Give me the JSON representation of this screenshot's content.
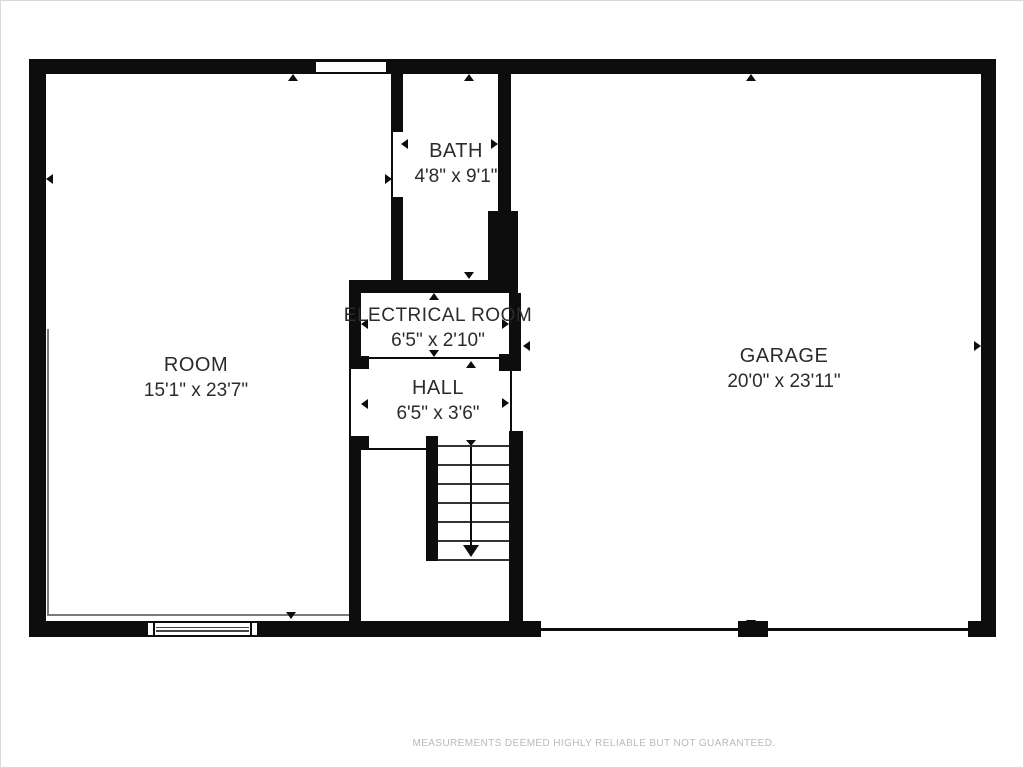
{
  "plan": {
    "rooms": [
      {
        "name": "ROOM",
        "dims": "15'1\" x 23'7\""
      },
      {
        "name": "BATH",
        "dims": "4'8\" x 9'1\""
      },
      {
        "name": "ELECTRICAL ROOM",
        "dims": "6'5\" x 2'10\""
      },
      {
        "name": "HALL",
        "dims": "6'5\" x 3'6\""
      },
      {
        "name": "GARAGE",
        "dims": "20'0\" x 23'11\""
      }
    ],
    "stairs": {
      "direction_icon": "down-arrow"
    },
    "footer_disclaimer": "MEASUREMENTS DEEMED HIGHLY RELIABLE BUT NOT GUARANTEED.",
    "colors": {
      "wall": "#0d0d0d",
      "label_text": "#2b2b2b",
      "footer_text": "#b9b9b9"
    }
  }
}
